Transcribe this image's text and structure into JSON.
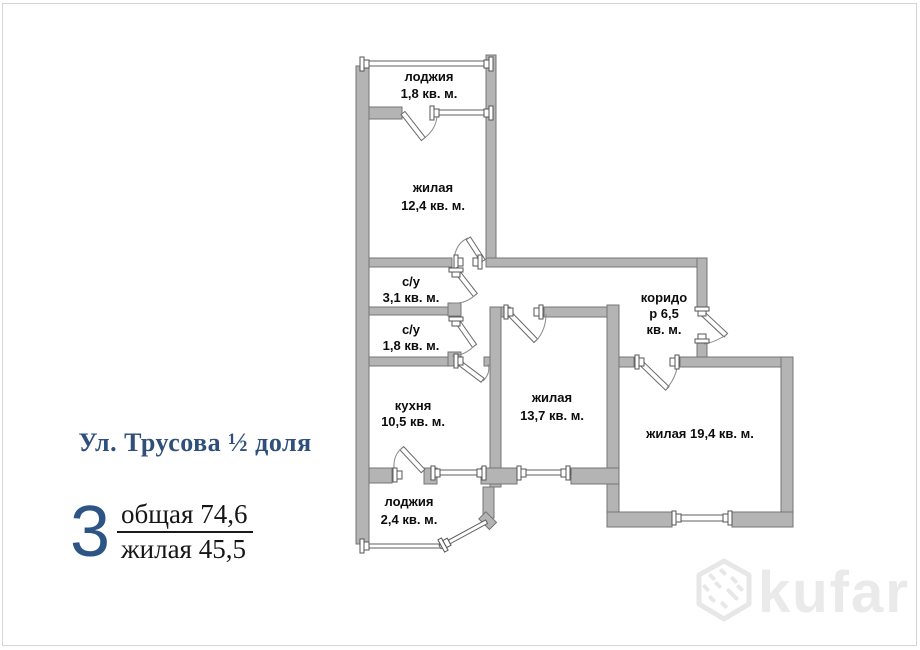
{
  "info": {
    "address": "Ул. Трусова ½ доля",
    "rooms_count": "3",
    "area_total_label": "общая",
    "area_total_value": "74,6",
    "area_living_label": "жилая",
    "area_living_value": "45,5"
  },
  "plan": {
    "rooms": {
      "loggia_top": {
        "name": "лоджия",
        "area": "1,8 кв. м."
      },
      "living_12": {
        "name": "жилая",
        "area": "12,4 кв. м."
      },
      "bath_31": {
        "name": "с/у",
        "area": "3,1 кв. м."
      },
      "bath_18": {
        "name": "с/у",
        "area": "1,8 кв. м."
      },
      "kitchen": {
        "name": "кухня",
        "area": "10,5 кв. м."
      },
      "living_137": {
        "name": "жилая",
        "area": "13,7 кв. м."
      },
      "corridor": {
        "line1": "коридо",
        "line2": "р 6,5",
        "line3": "кв. м."
      },
      "living_194": {
        "label": "жилая 19,4 кв. м."
      },
      "loggia_bottom": {
        "name": "лоджия",
        "area": "2,4 кв. м."
      }
    }
  },
  "watermark": {
    "brand": "kufar"
  },
  "colors": {
    "wall_fill": "#b4b4b4",
    "wall_outline": "#757575",
    "accent_blue": "#2c5485",
    "label_black": "#0d0d0d",
    "watermark_gray": "#e7e7e7",
    "frame_border": "#d5d5d5"
  }
}
